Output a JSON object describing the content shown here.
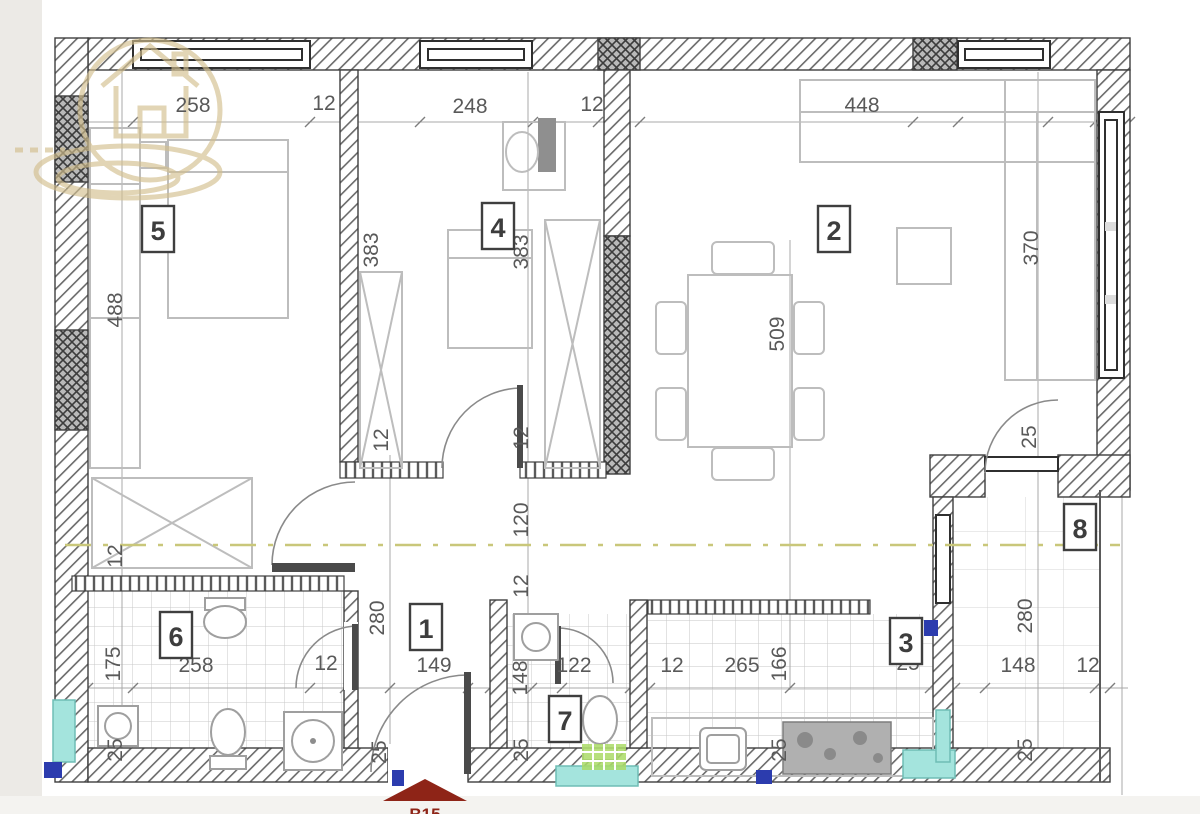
{
  "plan": {
    "rooms": [
      {
        "n": "5",
        "x": 142,
        "y": 206
      },
      {
        "n": "4",
        "x": 482,
        "y": 203
      },
      {
        "n": "2",
        "x": 818,
        "y": 206
      },
      {
        "n": "1",
        "x": 410,
        "y": 604
      },
      {
        "n": "6",
        "x": 160,
        "y": 612
      },
      {
        "n": "7",
        "x": 549,
        "y": 696
      },
      {
        "n": "3",
        "x": 890,
        "y": 618
      },
      {
        "n": "8",
        "x": 1064,
        "y": 504
      }
    ],
    "dimensions": [
      {
        "t": "258",
        "x": 193,
        "y": 112
      },
      {
        "t": "12",
        "x": 324,
        "y": 110
      },
      {
        "t": "248",
        "x": 470,
        "y": 113
      },
      {
        "t": "12",
        "x": 592,
        "y": 111
      },
      {
        "t": "448",
        "x": 862,
        "y": 112
      },
      {
        "t": "488",
        "x": 122,
        "y": 310,
        "r": 1
      },
      {
        "t": "12",
        "x": 122,
        "y": 556,
        "r": 1
      },
      {
        "t": "175",
        "x": 120,
        "y": 664,
        "r": 1
      },
      {
        "t": "25",
        "x": 122,
        "y": 750,
        "r": 1
      },
      {
        "t": "383",
        "x": 378,
        "y": 250,
        "r": 1
      },
      {
        "t": "12",
        "x": 388,
        "y": 440,
        "r": 1
      },
      {
        "t": "280",
        "x": 384,
        "y": 618,
        "r": 1
      },
      {
        "t": "25",
        "x": 386,
        "y": 752,
        "r": 1
      },
      {
        "t": "383",
        "x": 528,
        "y": 252,
        "r": 1
      },
      {
        "t": "12",
        "x": 528,
        "y": 438,
        "r": 1
      },
      {
        "t": "120",
        "x": 528,
        "y": 520,
        "r": 1
      },
      {
        "t": "12",
        "x": 528,
        "y": 586,
        "r": 1
      },
      {
        "t": "148",
        "x": 527,
        "y": 678,
        "r": 1
      },
      {
        "t": "25",
        "x": 528,
        "y": 750,
        "r": 1
      },
      {
        "t": "509",
        "x": 784,
        "y": 334,
        "r": 1
      },
      {
        "t": "166",
        "x": 786,
        "y": 664,
        "r": 1
      },
      {
        "t": "25",
        "x": 786,
        "y": 750,
        "r": 1
      },
      {
        "t": "370",
        "x": 1038,
        "y": 248,
        "r": 1
      },
      {
        "t": "25",
        "x": 1036,
        "y": 437,
        "r": 1
      },
      {
        "t": "280",
        "x": 1032,
        "y": 616,
        "r": 1
      },
      {
        "t": "25",
        "x": 1032,
        "y": 750,
        "r": 1
      },
      {
        "t": "258",
        "x": 196,
        "y": 672
      },
      {
        "t": "12",
        "x": 326,
        "y": 670
      },
      {
        "t": "149",
        "x": 434,
        "y": 672
      },
      {
        "t": "122",
        "x": 574,
        "y": 672
      },
      {
        "t": "12",
        "x": 672,
        "y": 672
      },
      {
        "t": "265",
        "x": 742,
        "y": 672
      },
      {
        "t": "25",
        "x": 908,
        "y": 670
      },
      {
        "t": "148",
        "x": 1018,
        "y": 672
      },
      {
        "t": "12",
        "x": 1088,
        "y": 672
      }
    ],
    "entrance": {
      "label": "B15"
    }
  },
  "colors": {
    "dim": "#595959",
    "teal": "#a4e4dd",
    "green": "#aadb66",
    "blue": "#2c3cae",
    "red": "#8e2417",
    "olive": "#c9c77a",
    "logo": "#d3bf8e"
  }
}
